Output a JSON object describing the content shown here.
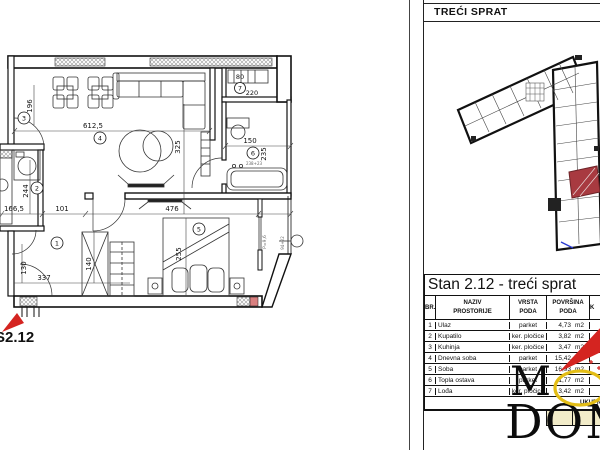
{
  "right_panel": {
    "floor_title": "TREĆI SPRAT",
    "table": {
      "title": "Stan 2.12 - treći sprat",
      "columns": {
        "br": "BR.",
        "naziv1": "NAZIV",
        "naziv2": "PROSTORIJE",
        "vrsta1": "VRSTA",
        "vrsta2": "PODA",
        "pov1": "POVRŠINA",
        "pov2": "PODA",
        "k": "K"
      },
      "rows": [
        {
          "br": "1",
          "naziv": "Ulaz",
          "vrsta": "parket",
          "value": "4,73",
          "unit": "m2"
        },
        {
          "br": "2",
          "naziv": "Kupatilo",
          "vrsta": "ker. pločice",
          "value": "3,82",
          "unit": "m2"
        },
        {
          "br": "3",
          "naziv": "Kuhinja",
          "vrsta": "ker. pločice",
          "value": "3,47",
          "unit": "m2"
        },
        {
          "br": "4",
          "naziv": "Dnevna soba",
          "vrsta": "parket",
          "value": "15,42",
          "unit": "m2"
        },
        {
          "br": "5",
          "naziv": "Soba",
          "vrsta": "parket",
          "value": "16,93",
          "unit": "m2"
        },
        {
          "br": "6",
          "naziv": "Topla ostava",
          "vrsta": "parket",
          "value": "1,77",
          "unit": "m2"
        },
        {
          "br": "7",
          "naziv": "Lođa",
          "vrsta": "ker. pločice",
          "value": "3,42",
          "unit": "m2"
        }
      ],
      "total_label": "UKUPNO"
    }
  },
  "watermark": {
    "line1": "M",
    "line2": "DOM"
  },
  "plan": {
    "unit_label": "S2.12",
    "rooms": {
      "r1": "1",
      "r2": "2",
      "r3": "3",
      "r4": "4",
      "r5": "5",
      "r6": "6",
      "r7": "7"
    },
    "dims": {
      "living_width": "612,5",
      "living_depth": "325",
      "kitchen": "196",
      "hall_a": "101",
      "hall_b": "337",
      "hall_c": "130",
      "closet": "140",
      "bath_w": "150",
      "bath_h": "235",
      "room2_h": "244",
      "room2_w": "166,5",
      "bed_w": "476",
      "bed_h": "255",
      "niche_w": "80",
      "niche_h": "220"
    },
    "specs": {
      "door1": "94+22",
      "door2": "238+23",
      "loggia": "P=9,6"
    }
  },
  "colors": {
    "highlight_unit": "#a83a40",
    "arrow_red": "#d42420",
    "circle_yellow": "#e3bd15",
    "total_cell": "#f2ecc9"
  }
}
